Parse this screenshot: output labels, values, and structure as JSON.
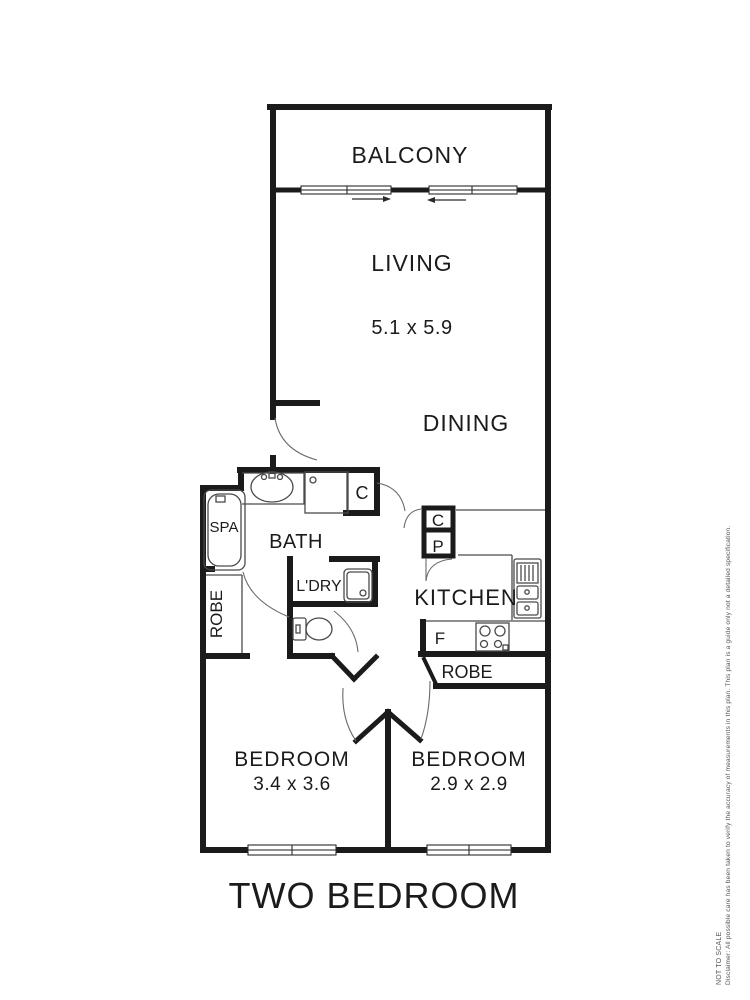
{
  "plan": {
    "balcony": {
      "label": "BALCONY"
    },
    "living": {
      "label": "LIVING",
      "dimensions": "5.1 x 5.9"
    },
    "dining": {
      "label": "DINING"
    },
    "bath": {
      "label": "BATH"
    },
    "spa": {
      "label": "SPA"
    },
    "laundry": {
      "label": "L'DRY"
    },
    "robe_left": {
      "label": "ROBE"
    },
    "kitchen": {
      "label": "KITCHEN"
    },
    "cupboard_bath": {
      "label": "C"
    },
    "cupboard_hall": {
      "label": "C"
    },
    "pantry": {
      "label": "P"
    },
    "fridge": {
      "label": "F"
    },
    "robe_bedroom2": {
      "label": "ROBE"
    },
    "bedroom1": {
      "label": "BEDROOM",
      "dimensions": "3.4 x 3.6"
    },
    "bedroom2": {
      "label": "BEDROOM",
      "dimensions": "2.9 x 2.9"
    }
  },
  "footer": {
    "plan_title": "TWO BEDROOM"
  },
  "disclaimer": {
    "scale_note": "NOT TO SCALE",
    "text": "Disclaimer: All possible care has been taken to verify the accuracy of measurements in this plan. This plan is a guide only not a detailed specification."
  },
  "colors": {
    "wall": "#1b1b1b",
    "fixture": "#4a4a4a",
    "background": "#ffffff"
  }
}
